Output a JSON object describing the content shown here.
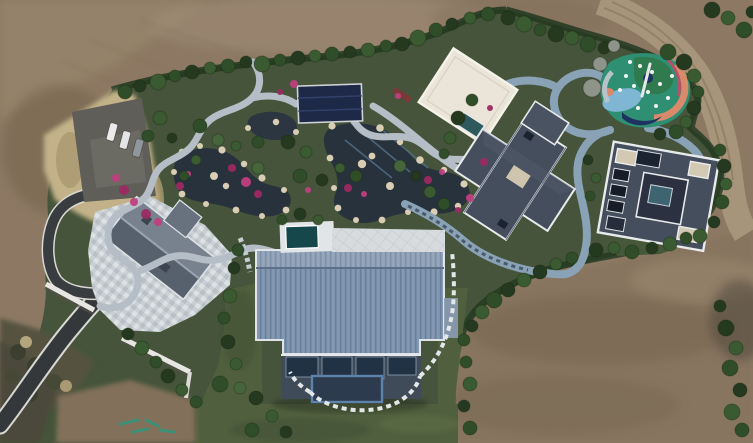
{
  "meta": {
    "kind": "aerial-drone-photograph",
    "description": "Top-down aerial photo of a landscaped estate compound surrounded by bare brown earth: winding garden ponds with rock edges and pink flower beds, a large ribbed blue-grey roofed main house, three grey-roofed villas, a cream flat-roof pavilion, a colorful painted playground, a dark asphalt driveway with parked cars, and a dirt road at top right.",
    "width": 753,
    "height": 443
  },
  "landmarks": [
    "bare-earth-terrain",
    "boundary-hedge",
    "dry-grass-bank",
    "parking-lot",
    "cars",
    "driveway",
    "retaining-walls",
    "guest-house",
    "mosaic-courtyard",
    "garden-ponds",
    "flower-beds",
    "stone-paths",
    "navy-pavilion",
    "white-roof-pavilion",
    "plunge-pool",
    "central-villa",
    "east-villa",
    "playground",
    "blue-winding-path",
    "stepping-stone-path",
    "main-house-roof",
    "main-house-facade",
    "lawn",
    "scrub-slope",
    "dirt-road"
  ],
  "palette": {
    "dirt": "#8d7963",
    "dirtLight": "#a3907607",
    "dirtBand": "#9d8a70",
    "dirtDark": "#74634e",
    "dirtBottomRight": "#87755f",
    "roadDirt": "#a8967c",
    "estate": "#45543a",
    "hedge": "#223820",
    "lawn": "#50603e",
    "lawnDark": "#3c4a30",
    "dryGrass": "#c3b289",
    "scrub": "#55523f",
    "scrubDark": "#3c3f30",
    "asphalt": "#35383a",
    "roadEdge": "#d8d8d4",
    "parking": "#5f5e58",
    "mosaicBase": "#c9cfd3",
    "pond": "#27323c",
    "rock": "#d9cdb3",
    "flower": "#bf3f7e",
    "flowerDark": "#9c2a62",
    "stonePath": "#b5bec6",
    "bluePath": "#8aa2b6",
    "deck": "#e2e5e8",
    "poolTeal": "#15474b",
    "navyRoof": "#1d2946",
    "creamRoof": "#eae5d8",
    "tealPool2": "#2e5a5e",
    "guestRoofLight": "#78828e",
    "guestRoofDark": "#57616d",
    "villaRoof": "#454e5c",
    "villaRoofDark": "#2b3140",
    "villaTrim": "#e8eaec",
    "ribbedRoof": "#7e93ad",
    "facade": "#3f4b59",
    "glass": "#223245",
    "glassFrame": "#5d83ad",
    "playTeal": "#2e8f72",
    "playGreen": "#2f7a4f",
    "playBlue": "#7fb6d4",
    "playSalmon": "#d98a6b",
    "playRed": "#b8506a",
    "playNavy": "#1d3260",
    "treeColors": [
      "#24391f",
      "#2f4d28",
      "#3a5a31",
      "#2c4631",
      "#46653c",
      "#8e948a",
      "#5d6f45"
    ],
    "carColors": [
      "#ebebeb",
      "#e2e4e6",
      "#8f969c"
    ]
  },
  "scene": {
    "trees": [
      [
        125,
        92,
        7,
        1
      ],
      [
        140,
        86,
        6,
        0
      ],
      [
        158,
        82,
        8,
        2
      ],
      [
        175,
        76,
        6,
        1
      ],
      [
        192,
        72,
        7,
        0
      ],
      [
        210,
        68,
        6,
        2
      ],
      [
        228,
        66,
        7,
        1
      ],
      [
        246,
        62,
        6,
        0
      ],
      [
        262,
        64,
        8,
        2
      ],
      [
        280,
        60,
        6,
        1
      ],
      [
        298,
        58,
        7,
        0
      ],
      [
        315,
        56,
        6,
        2
      ],
      [
        332,
        54,
        7,
        1
      ],
      [
        350,
        52,
        6,
        0
      ],
      [
        368,
        50,
        7,
        2
      ],
      [
        386,
        46,
        6,
        1
      ],
      [
        402,
        44,
        7,
        0
      ],
      [
        418,
        38,
        8,
        2
      ],
      [
        436,
        30,
        7,
        1
      ],
      [
        452,
        24,
        6,
        0
      ],
      [
        470,
        18,
        6,
        2
      ],
      [
        488,
        14,
        7,
        1
      ],
      [
        508,
        18,
        7,
        0
      ],
      [
        524,
        24,
        8,
        2
      ],
      [
        540,
        30,
        6,
        1
      ],
      [
        556,
        34,
        8,
        0
      ],
      [
        572,
        38,
        7,
        2
      ],
      [
        588,
        44,
        8,
        1
      ],
      [
        604,
        48,
        6,
        0
      ],
      [
        668,
        52,
        8,
        1
      ],
      [
        684,
        62,
        8,
        0
      ],
      [
        694,
        76,
        7,
        2
      ],
      [
        698,
        92,
        6,
        1
      ],
      [
        694,
        108,
        7,
        0
      ],
      [
        686,
        122,
        6,
        2
      ],
      [
        676,
        132,
        7,
        1
      ],
      [
        660,
        134,
        6,
        0
      ],
      [
        592,
        88,
        9,
        5
      ],
      [
        600,
        64,
        7,
        5
      ],
      [
        614,
        46,
        6,
        5
      ],
      [
        712,
        10,
        8,
        0
      ],
      [
        728,
        18,
        7,
        2
      ],
      [
        744,
        30,
        8,
        1
      ],
      [
        752,
        12,
        6,
        0
      ],
      [
        720,
        150,
        6,
        1
      ],
      [
        724,
        166,
        7,
        0
      ],
      [
        726,
        184,
        6,
        2
      ],
      [
        722,
        202,
        7,
        1
      ],
      [
        714,
        222,
        6,
        0
      ],
      [
        700,
        236,
        7,
        2
      ],
      [
        588,
        160,
        5,
        0
      ],
      [
        596,
        178,
        5,
        2
      ],
      [
        590,
        196,
        5,
        1
      ],
      [
        472,
        100,
        6,
        1
      ],
      [
        458,
        118,
        7,
        0
      ],
      [
        450,
        138,
        6,
        2
      ],
      [
        444,
        154,
        5,
        1
      ],
      [
        596,
        250,
        7,
        0
      ],
      [
        614,
        248,
        6,
        2
      ],
      [
        632,
        252,
        7,
        1
      ],
      [
        652,
        248,
        6,
        0
      ],
      [
        670,
        244,
        7,
        2
      ],
      [
        686,
        238,
        6,
        1
      ],
      [
        540,
        272,
        7,
        0
      ],
      [
        556,
        264,
        6,
        2
      ],
      [
        572,
        258,
        6,
        1
      ],
      [
        524,
        280,
        7,
        2
      ],
      [
        508,
        290,
        7,
        0
      ],
      [
        494,
        300,
        8,
        1
      ],
      [
        482,
        312,
        7,
        2
      ],
      [
        472,
        326,
        6,
        0
      ],
      [
        464,
        340,
        6,
        1
      ],
      [
        160,
        118,
        7,
        2
      ],
      [
        148,
        136,
        6,
        1
      ],
      [
        172,
        138,
        5,
        0
      ],
      [
        200,
        126,
        7,
        1
      ],
      [
        218,
        140,
        6,
        4
      ],
      [
        236,
        146,
        5,
        2
      ],
      [
        258,
        142,
        6,
        1
      ],
      [
        288,
        142,
        7,
        0
      ],
      [
        306,
        152,
        6,
        2
      ],
      [
        258,
        168,
        6,
        4
      ],
      [
        300,
        176,
        7,
        1
      ],
      [
        322,
        180,
        6,
        0
      ],
      [
        340,
        168,
        5,
        2
      ],
      [
        356,
        176,
        6,
        1
      ],
      [
        400,
        166,
        6,
        4
      ],
      [
        416,
        176,
        5,
        0
      ],
      [
        430,
        192,
        6,
        2
      ],
      [
        444,
        204,
        6,
        1
      ],
      [
        300,
        214,
        6,
        0
      ],
      [
        318,
        220,
        5,
        2
      ],
      [
        282,
        220,
        5,
        1
      ],
      [
        196,
        160,
        5,
        2
      ],
      [
        184,
        176,
        5,
        1
      ],
      [
        238,
        250,
        6,
        1
      ],
      [
        234,
        268,
        6,
        0
      ],
      [
        230,
        296,
        7,
        2
      ],
      [
        224,
        318,
        6,
        1
      ],
      [
        228,
        342,
        7,
        0
      ],
      [
        236,
        364,
        6,
        2
      ],
      [
        220,
        384,
        8,
        1
      ],
      [
        240,
        388,
        6,
        4
      ],
      [
        256,
        398,
        7,
        0
      ],
      [
        272,
        416,
        6,
        2
      ],
      [
        252,
        430,
        7,
        1
      ],
      [
        286,
        432,
        6,
        0
      ],
      [
        466,
        362,
        6,
        1
      ],
      [
        470,
        384,
        7,
        2
      ],
      [
        464,
        406,
        6,
        0
      ],
      [
        470,
        428,
        7,
        1
      ],
      [
        128,
        334,
        6,
        0
      ],
      [
        142,
        348,
        7,
        2
      ],
      [
        156,
        362,
        6,
        1
      ],
      [
        168,
        376,
        7,
        0
      ],
      [
        182,
        390,
        6,
        2
      ],
      [
        196,
        402,
        6,
        1
      ],
      [
        726,
        328,
        8,
        0
      ],
      [
        736,
        348,
        7,
        2
      ],
      [
        730,
        368,
        8,
        1
      ],
      [
        740,
        390,
        7,
        0
      ],
      [
        732,
        412,
        8,
        2
      ],
      [
        742,
        430,
        7,
        1
      ],
      [
        720,
        306,
        6,
        0
      ]
    ],
    "flowers": [
      [
        116,
        178,
        4
      ],
      [
        124,
        190,
        5
      ],
      [
        134,
        202,
        4
      ],
      [
        146,
        214,
        5
      ],
      [
        158,
        222,
        4
      ],
      [
        180,
        186,
        4
      ],
      [
        188,
        174,
        3
      ],
      [
        232,
        168,
        4
      ],
      [
        246,
        182,
        5
      ],
      [
        258,
        194,
        4
      ],
      [
        308,
        190,
        3
      ],
      [
        348,
        188,
        4
      ],
      [
        364,
        194,
        3
      ],
      [
        428,
        180,
        4
      ],
      [
        442,
        172,
        3
      ],
      [
        484,
        162,
        4
      ],
      [
        470,
        198,
        4
      ],
      [
        458,
        210,
        3
      ],
      [
        294,
        84,
        4
      ],
      [
        280,
        92,
        3
      ],
      [
        398,
        96,
        3
      ],
      [
        490,
        108,
        3
      ]
    ],
    "playgroundDots": [
      [
        626,
        76
      ],
      [
        640,
        66
      ],
      [
        652,
        72
      ],
      [
        660,
        84
      ],
      [
        648,
        92
      ],
      [
        634,
        86
      ],
      [
        668,
        98
      ],
      [
        620,
        90
      ],
      [
        656,
        106
      ],
      [
        638,
        108
      ],
      [
        672,
        76
      ],
      [
        630,
        62
      ]
    ],
    "cars": [
      {
        "x": 112,
        "y": 132,
        "rot": 15,
        "color": 0
      },
      {
        "x": 125,
        "y": 140,
        "rot": 15,
        "color": 1
      },
      {
        "x": 138,
        "y": 148,
        "rot": 15,
        "color": 2
      }
    ]
  }
}
